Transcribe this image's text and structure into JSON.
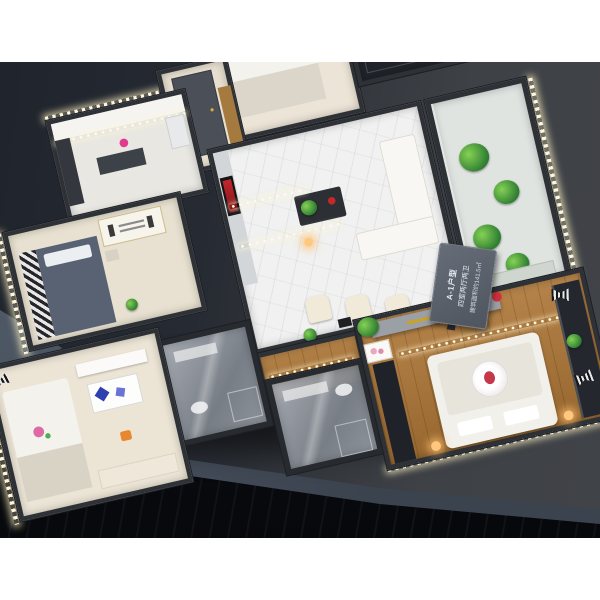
{
  "placard": {
    "lines": [
      "A-1户型",
      "四室两厅两卫",
      "建筑面积约141.5㎡"
    ]
  },
  "palette": {
    "backdrop_left": "#20242c",
    "backdrop_right": "#404348",
    "table_surface": "#55606e",
    "model_wall": "#2e3237",
    "led_cool": "#fffbe4",
    "led_warm": "#ffd98a",
    "marble_floor": "#f0f1f0",
    "wood_floor": "#b5834a",
    "tv_screen_red": "#c1272d",
    "plant_green": "#4caf50",
    "rose_pink": "#dd6aa2",
    "bag_orange": "#e8872e",
    "placard_gray": "#59606b"
  },
  "scene": {
    "rooms": [
      "kitchen",
      "entry-hall",
      "north-bedroom",
      "lobby",
      "east-balcony",
      "living-dining-room",
      "corridor",
      "bathroom-1",
      "bathroom-2",
      "bedroom-a",
      "bedroom-b",
      "master-bedroom"
    ]
  }
}
